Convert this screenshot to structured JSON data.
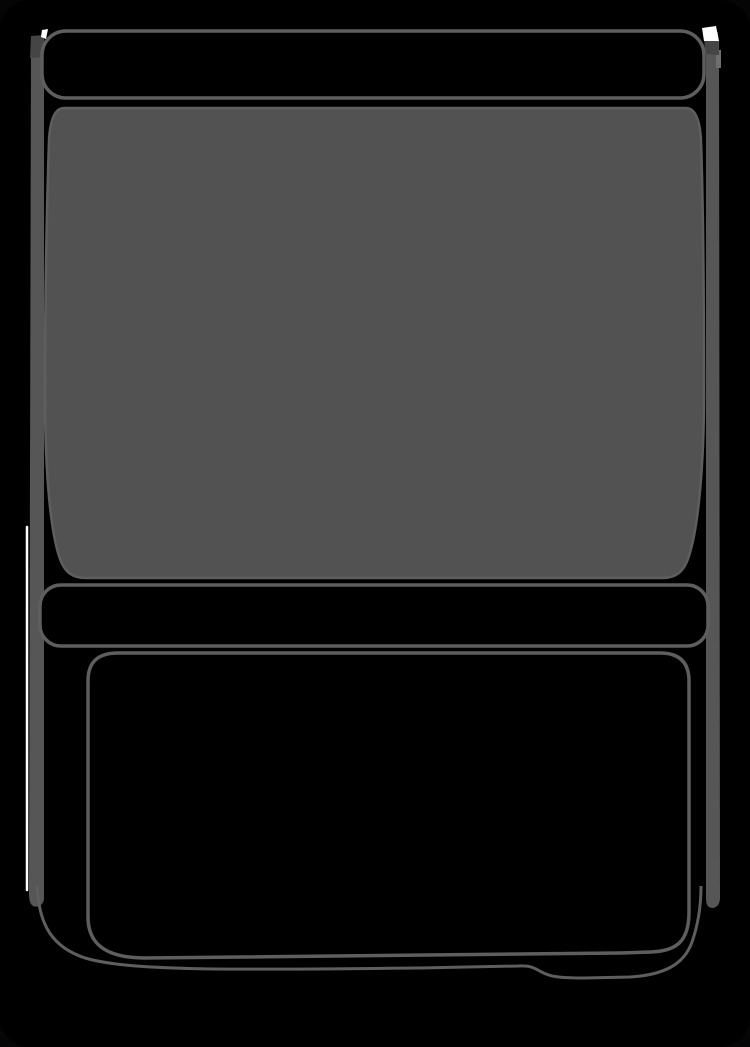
{
  "illustration": {
    "alt": "Dark monochrome outline illustration of a boxy appliance-style object: a rounded top panel bar, a large gray window panel with gently bowed sides, a horizontal handle bar, and a lower drawer compartment with a notched bottom edge, drawn on a black background"
  },
  "colors": {
    "backdrop": "#050505",
    "shell": "#000000",
    "panel_fill": "#000000",
    "window_fill": "#525252",
    "side_band": "#565656",
    "band_light": "#6e6e6e",
    "outline": "#5e5e5e",
    "corner_shadow": "#454545",
    "highlight": "#ffffff"
  }
}
